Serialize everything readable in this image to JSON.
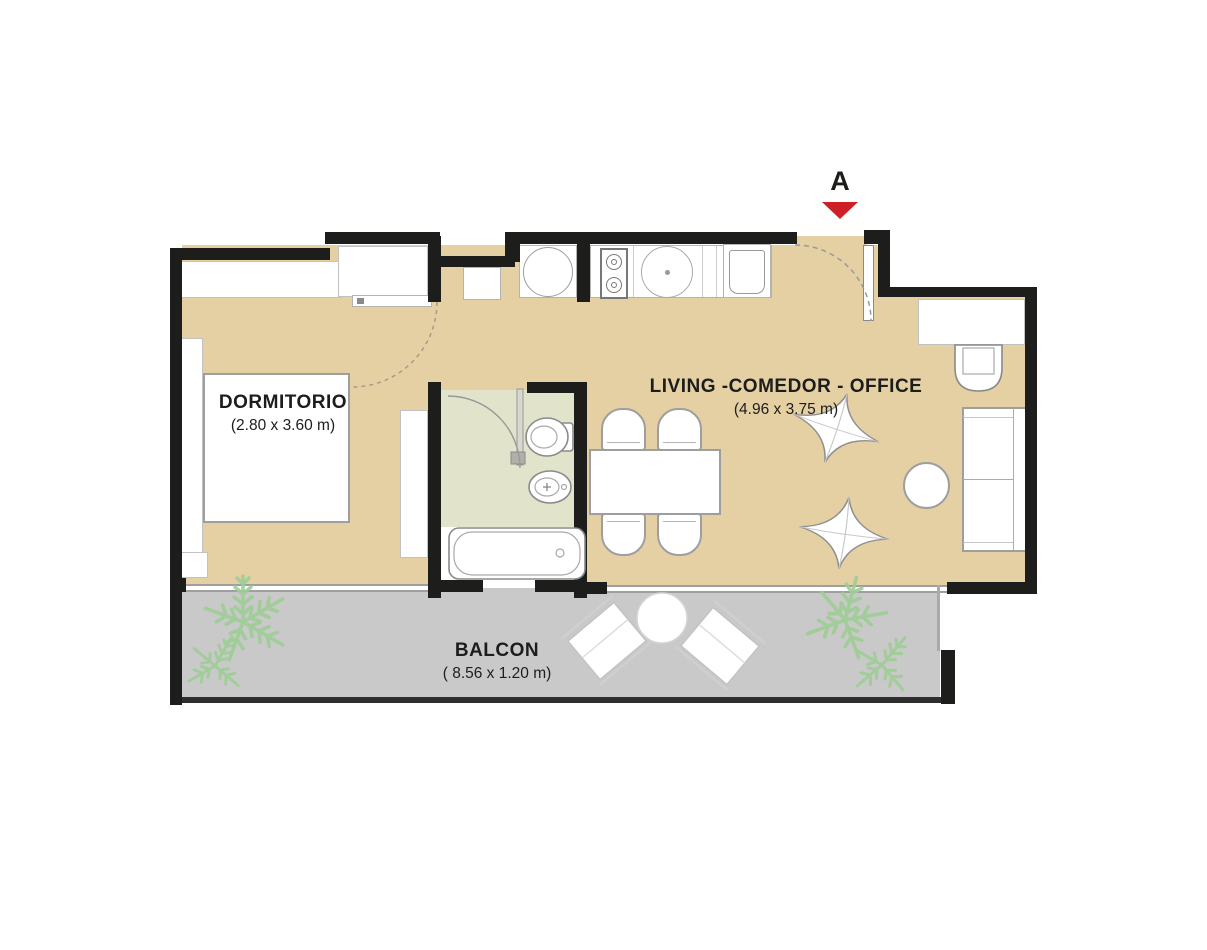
{
  "marker": {
    "label": "A"
  },
  "rooms": {
    "dormitorio": {
      "name": "DORMITORIO",
      "dims": "(2.80 x 3.60 m)"
    },
    "living": {
      "name": "LIVING -COMEDOR - OFFICE",
      "dims": "(4.96 x 3.75 m)"
    },
    "balcon": {
      "name": "BALCON",
      "dims": "( 8.56 x 1.20 m)"
    }
  },
  "colors": {
    "wall": "#1d1d1b",
    "floor": "#e5d0a4",
    "balcony_floor": "#c9c9c9",
    "bathroom_floor": "#e1e4cb",
    "arrow": "#cf2027",
    "plant": "#9dcd96"
  }
}
